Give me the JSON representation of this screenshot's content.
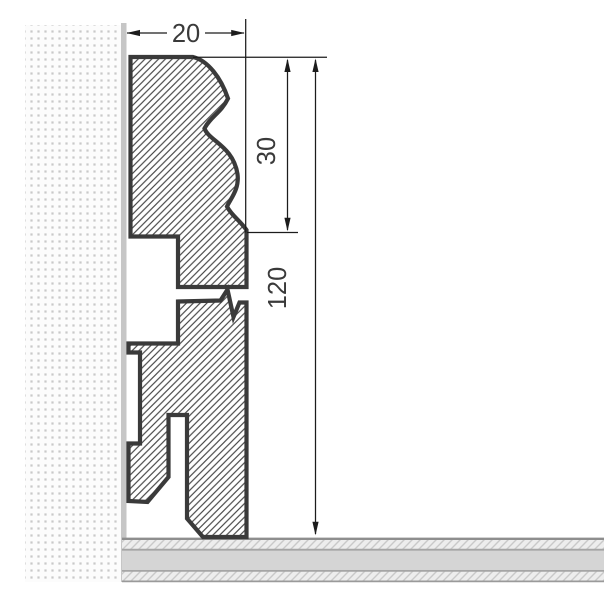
{
  "drawing": {
    "type": "technical-section-drawing",
    "subject": "Skirting board profile cross-section mounted on wall above floor",
    "dimension_labels": {
      "width": "20",
      "top_profile_height": "30",
      "total_height": "120"
    },
    "colors": {
      "outline": "#3a3a3a",
      "dimension_line": "#1c1c1c",
      "label_text": "#3a3a3a",
      "wall_dots": "#c9c9c9",
      "wall_edge": "#c6c6c6",
      "hatch_line": "#474747",
      "floor_band_solid": "#d5d5d5",
      "floor_band_light": "#ededed",
      "floor_hatch_line": "#c9c9c9",
      "floor_divider": "#9c9c9c"
    }
  }
}
